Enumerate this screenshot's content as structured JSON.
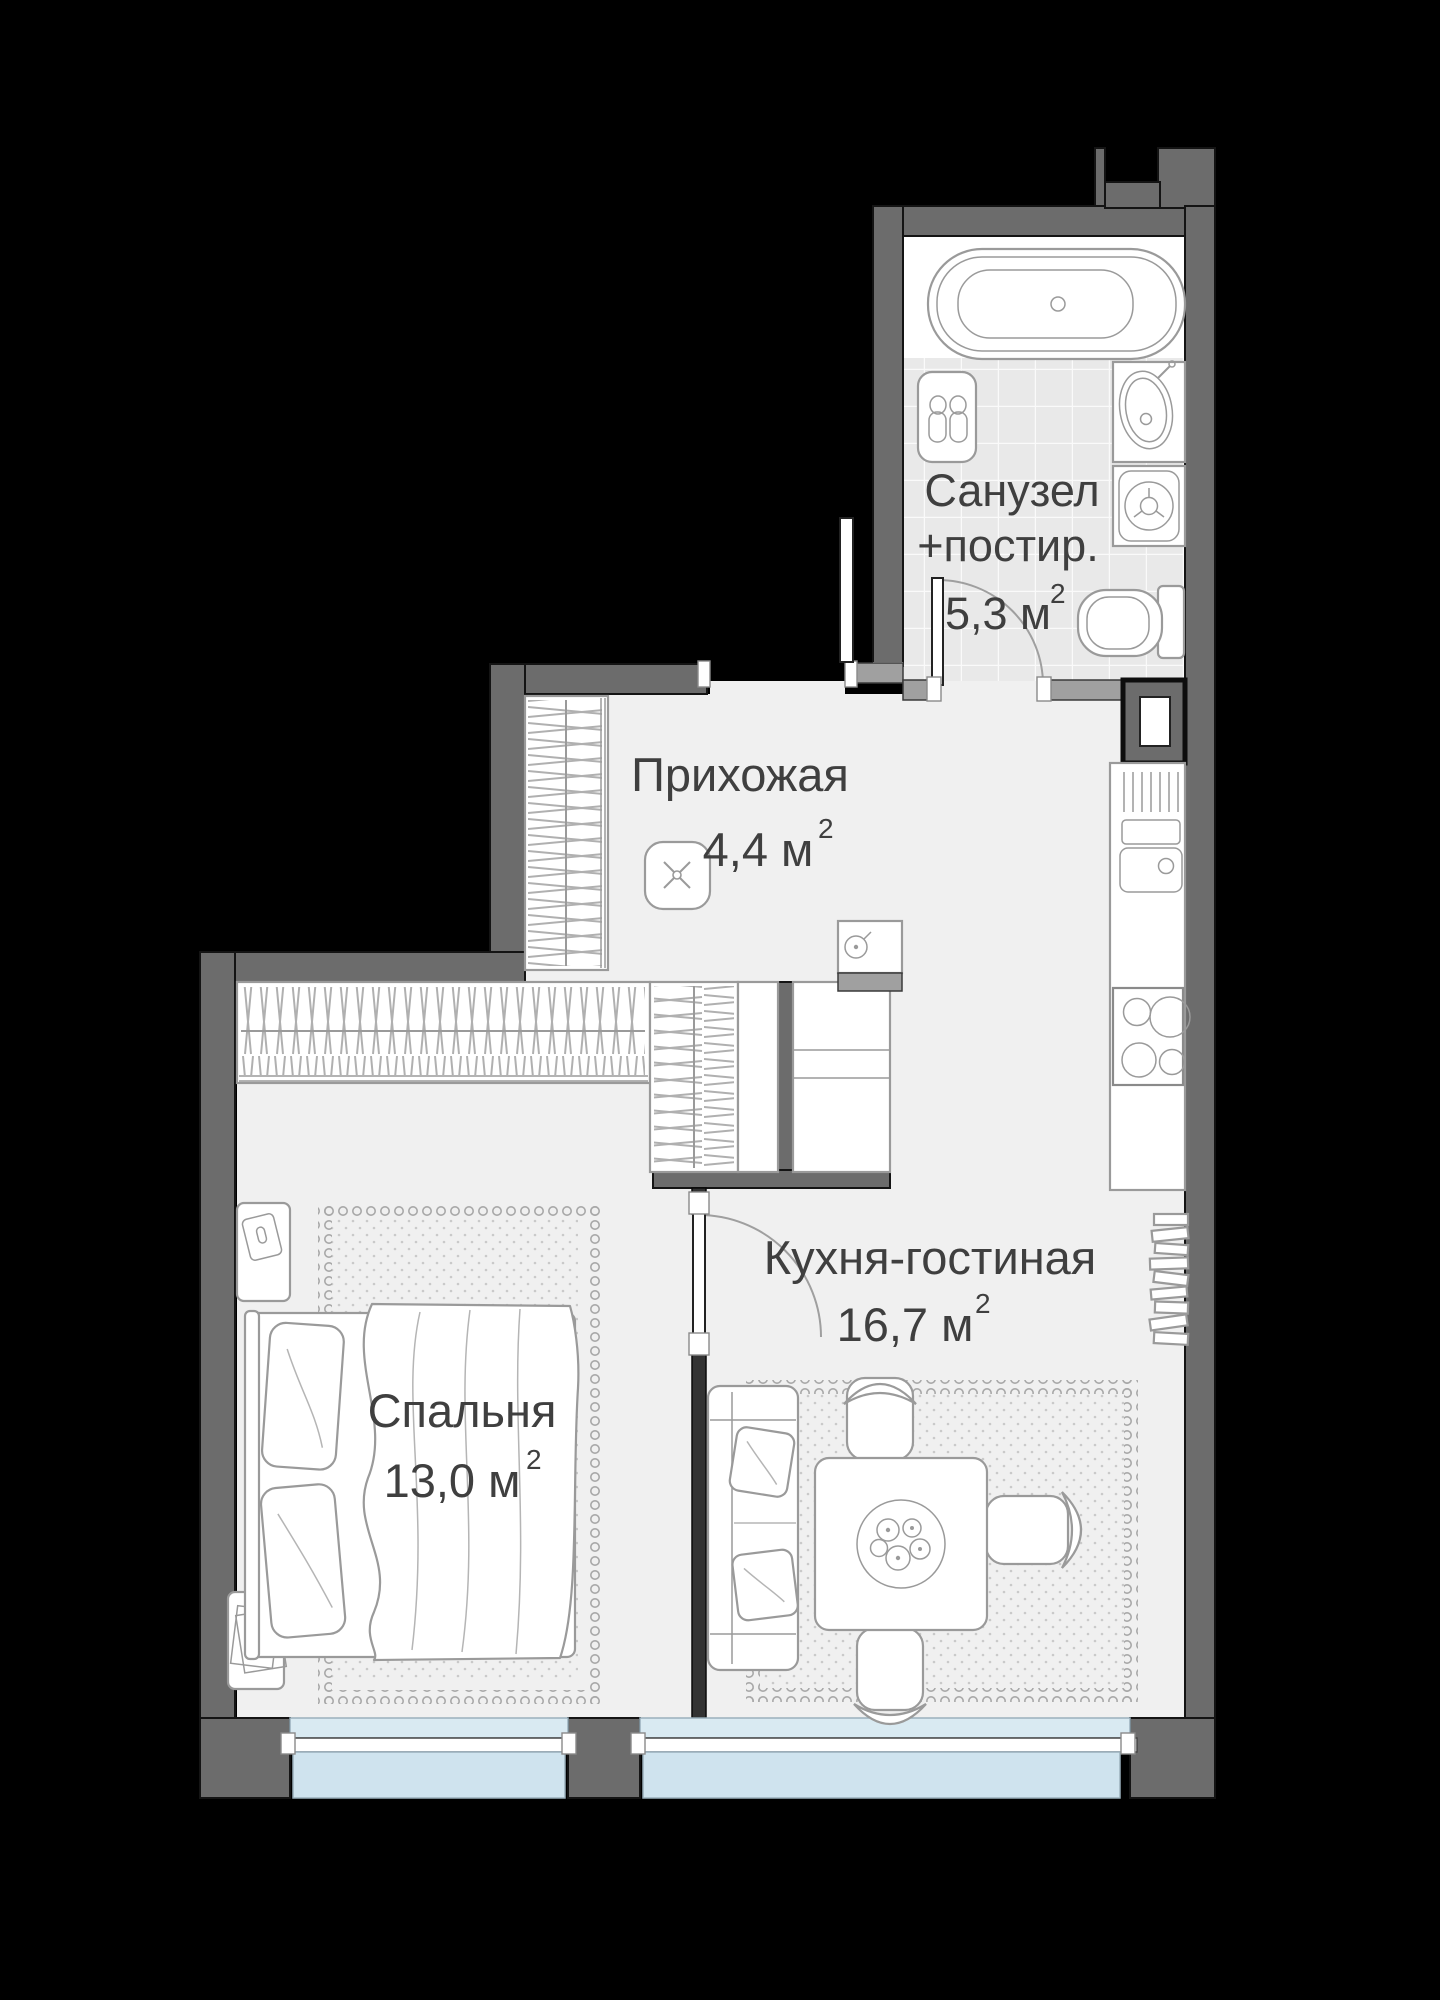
{
  "plan": {
    "type": "apartment-floor-plan",
    "rooms": [
      {
        "id": "bathroom",
        "name": "Санузел",
        "name2": "+постир.",
        "area": "5,3 м",
        "area_sup": "2"
      },
      {
        "id": "hallway",
        "name": "Прихожая",
        "area": "4,4 м",
        "area_sup": "2"
      },
      {
        "id": "kitchen_living",
        "name": "Кухня-гостиная",
        "area": "16,7 м",
        "area_sup": "2"
      },
      {
        "id": "bedroom",
        "name": "Спальня",
        "area": "13,0 м",
        "area_sup": "2"
      }
    ],
    "colors": {
      "background": "#000000",
      "wall": "#6c6c6c",
      "wall_light": "#a0a0a0",
      "floor": "#f0f0f0",
      "tile": "#e9e9e9",
      "window_glass": "#d9eaf2",
      "window_outer": "#cfe3ee",
      "furniture_outline": "#9a9a9a",
      "text": "#3f3f3f"
    }
  }
}
